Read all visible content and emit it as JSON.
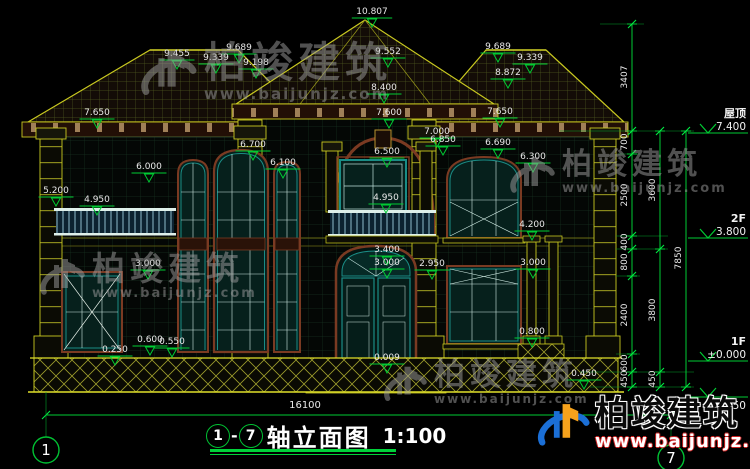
{
  "drawing": {
    "title_block": {
      "axis_start": "1",
      "separator": "-",
      "axis_end": "7",
      "name": "轴立面图",
      "scale": "1:100"
    },
    "bottom_dimension": {
      "text": "16100",
      "x": 305,
      "y": 408
    },
    "elevation_marks": [
      {
        "text": "10.807",
        "x": 372,
        "y": 11
      },
      {
        "text": "9.552",
        "x": 388,
        "y": 51
      },
      {
        "text": "9.689",
        "x": 239,
        "y": 47
      },
      {
        "text": "9.455",
        "x": 177,
        "y": 53
      },
      {
        "text": "9.339",
        "x": 216,
        "y": 57
      },
      {
        "text": "9.198",
        "x": 256,
        "y": 62
      },
      {
        "text": "9.689",
        "x": 498,
        "y": 46
      },
      {
        "text": "9.339",
        "x": 530,
        "y": 57
      },
      {
        "text": "8.872",
        "x": 508,
        "y": 72
      },
      {
        "text": "8.400",
        "x": 384,
        "y": 87
      },
      {
        "text": "7.600",
        "x": 389,
        "y": 112
      },
      {
        "text": "7.650",
        "x": 97,
        "y": 112
      },
      {
        "text": "7.650",
        "x": 500,
        "y": 111
      },
      {
        "text": "7.000",
        "x": 437,
        "y": 131
      },
      {
        "text": "6.850",
        "x": 443,
        "y": 139
      },
      {
        "text": "6.690",
        "x": 498,
        "y": 142
      },
      {
        "text": "6.300",
        "x": 533,
        "y": 156
      },
      {
        "text": "6.500",
        "x": 387,
        "y": 151
      },
      {
        "text": "6.700",
        "x": 253,
        "y": 144
      },
      {
        "text": "6.100",
        "x": 283,
        "y": 162
      },
      {
        "text": "6.000",
        "x": 149,
        "y": 166
      },
      {
        "text": "5.200",
        "x": 56,
        "y": 190
      },
      {
        "text": "4.950",
        "x": 97,
        "y": 199
      },
      {
        "text": "4.950",
        "x": 386,
        "y": 197
      },
      {
        "text": "4.200",
        "x": 532,
        "y": 224
      },
      {
        "text": "3.400",
        "x": 387,
        "y": 249
      },
      {
        "text": "3.000",
        "x": 387,
        "y": 262
      },
      {
        "text": "2.950",
        "x": 432,
        "y": 263
      },
      {
        "text": "3.000",
        "x": 148,
        "y": 263
      },
      {
        "text": "3.000",
        "x": 533,
        "y": 262
      },
      {
        "text": "0.800",
        "x": 532,
        "y": 331
      },
      {
        "text": "0.600",
        "x": 150,
        "y": 339
      },
      {
        "text": "0.550",
        "x": 172,
        "y": 341
      },
      {
        "text": "0.250",
        "x": 115,
        "y": 349
      },
      {
        "text": "0.009",
        "x": 387,
        "y": 357
      },
      {
        "text": "0.450",
        "x": 584,
        "y": 373
      }
    ],
    "right_chains": [
      {
        "x": 632,
        "ticks": [
          24,
          131,
          154,
          236,
          249,
          276,
          354,
          372,
          387
        ],
        "labels": [
          {
            "text": "3407",
            "y": 77
          },
          {
            "text": "700",
            "y": 142
          },
          {
            "text": "2500",
            "y": 195
          },
          {
            "text": "400",
            "y": 242
          },
          {
            "text": "800",
            "y": 262
          },
          {
            "text": "2400",
            "y": 315
          },
          {
            "text": "600",
            "y": 363
          },
          {
            "text": "450",
            "y": 379
          }
        ]
      },
      {
        "x": 660,
        "ticks": [
          131,
          249,
          372,
          387
        ],
        "labels": [
          {
            "text": "3600",
            "y": 190
          },
          {
            "text": "3800",
            "y": 310
          },
          {
            "text": "450",
            "y": 379
          }
        ]
      },
      {
        "x": 686,
        "ticks": [
          131,
          387
        ],
        "labels": [
          {
            "text": "7850",
            "y": 258
          }
        ]
      }
    ],
    "level_markers": [
      {
        "name": "屋顶",
        "value": "7.400",
        "y": 133
      },
      {
        "name": "2F",
        "value": "3.800",
        "y": 238
      },
      {
        "name": "1F",
        "value": "±0.000",
        "y": 361
      },
      {
        "name": "",
        "value": "-0.450",
        "y": 397,
        "below": true
      }
    ],
    "axis_bubbles": [
      {
        "label": "1",
        "x": 46,
        "y": 450
      },
      {
        "label": "7",
        "x": 671,
        "y": 458
      }
    ]
  },
  "watermarks": [
    {
      "brand": "柏竣建筑",
      "url": "www.baijunjz.com",
      "x": 136,
      "y": 42,
      "brand_size": 42,
      "url_size": 15,
      "logo_size": 62
    },
    {
      "brand": "柏竣建筑",
      "url": "www.baijunjz.com",
      "x": 506,
      "y": 150,
      "brand_size": 30,
      "url_size": 13,
      "logo_size": 50
    },
    {
      "brand": "柏竣建筑",
      "url": "www.baijunjz.com",
      "x": 36,
      "y": 252,
      "brand_size": 33,
      "url_size": 13,
      "logo_size": 50
    },
    {
      "brand": "柏竣建筑",
      "url": "www.baijunjz.com",
      "x": 380,
      "y": 360,
      "brand_size": 31,
      "url_size": 12,
      "logo_size": 48
    }
  ],
  "brand_logo": {
    "brand": "柏竣建筑",
    "url": "www.baijunjz.com"
  },
  "colors": {
    "dim_green": "#00cc33",
    "struct_yellow": "#c9c920",
    "window_teal": "#1a8c85",
    "frame_maroon": "#7a3a22",
    "text_white": "#e9e9e9",
    "logo_blue": "#1b6fd6",
    "logo_orange": "#f6a21c",
    "watermark_gray": "#9f9f9f"
  }
}
